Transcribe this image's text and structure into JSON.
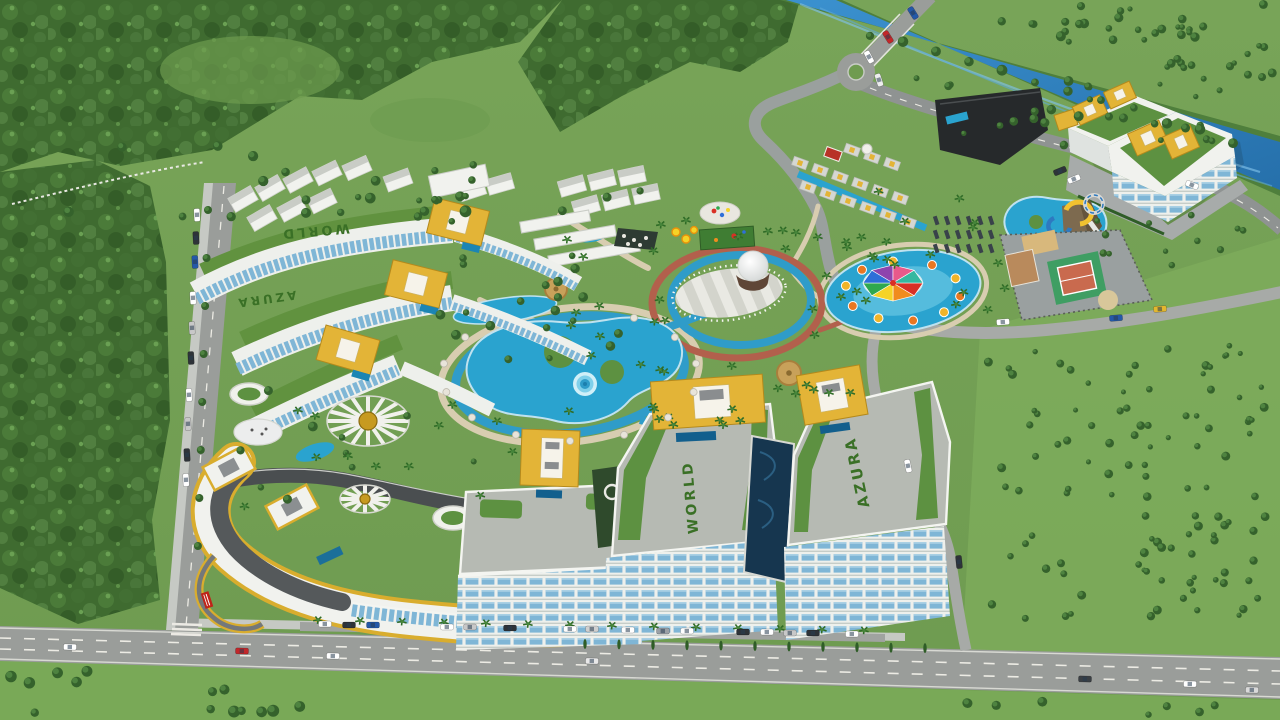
{
  "scene": {
    "type": "aerial-3d-architectural-render",
    "subject": "Azura World resort complex masterplan with water park, pools, amphitheater and river",
    "labels": {
      "tower_world_roof": "WORLD",
      "tower_azura_roof": "AZURA",
      "lawn_upper": "WORLD",
      "lawn_lower": "AZURA"
    },
    "palette": {
      "grass": "#76a155",
      "grass_light": "#7fae5c",
      "forest": "#3f6b30",
      "river": "#2f84c4",
      "road": "#9a9d9a",
      "sidewalk": "#c6c9c4",
      "building_white": "#f1f2ee",
      "roof_deck": "#b6bab3",
      "glass_blue": "#7fb6d6",
      "gold": "#e3b437",
      "pool_blue": "#2aa3cf",
      "canal_navy": "#16364f",
      "path_tan": "#d8cdb0",
      "track_red": "#b2604c",
      "lawn_green": "#5d9141",
      "hedge_green": "#3a7026",
      "court_green": "#3f9e63",
      "court_clay": "#c96a4e",
      "sand": "#d8b87c",
      "dark_roof": "#26292b",
      "accent_red": "#c0392b"
    },
    "splash_canopy_colors": [
      "#d93025",
      "#f08c1e",
      "#f5d327",
      "#2fa84f",
      "#2e6fd8",
      "#8e44ad",
      "#e8598a",
      "#35b8a0"
    ],
    "vehicles": [
      {
        "x": 70,
        "y": 647,
        "rot": 1,
        "color": "#ffffff"
      },
      {
        "x": 242,
        "y": 651,
        "rot": 1,
        "color": "#c2272a"
      },
      {
        "x": 333,
        "y": 656,
        "rot": 1,
        "color": "#ffffff"
      },
      {
        "x": 592,
        "y": 661,
        "rot": 1,
        "color": "#e8e8e8"
      },
      {
        "x": 1085,
        "y": 679,
        "rot": 1,
        "color": "#3a3f44"
      },
      {
        "x": 1190,
        "y": 684,
        "rot": 1,
        "color": "#ffffff"
      },
      {
        "x": 1252,
        "y": 690,
        "rot": 1,
        "color": "#d9d9d9"
      },
      {
        "x": 325,
        "y": 624,
        "rot": 0,
        "color": "#ffffff"
      },
      {
        "x": 349,
        "y": 625,
        "rot": 0,
        "color": "#2e3338"
      },
      {
        "x": 373,
        "y": 625,
        "rot": 0,
        "color": "#2458a8"
      },
      {
        "x": 447,
        "y": 627,
        "rot": 0,
        "color": "#ffffff"
      },
      {
        "x": 470,
        "y": 627,
        "rot": 0,
        "color": "#c8c8c8"
      },
      {
        "x": 510,
        "y": 628,
        "rot": 0,
        "color": "#2e3338"
      },
      {
        "x": 570,
        "y": 629,
        "rot": 0,
        "color": "#ffffff"
      },
      {
        "x": 592,
        "y": 629,
        "rot": 0,
        "color": "#d0d0d0"
      },
      {
        "x": 628,
        "y": 630,
        "rot": 0,
        "color": "#ffffff"
      },
      {
        "x": 663,
        "y": 631,
        "rot": 0,
        "color": "#9aa0a6"
      },
      {
        "x": 687,
        "y": 631,
        "rot": 0,
        "color": "#ffffff"
      },
      {
        "x": 743,
        "y": 632,
        "rot": 0,
        "color": "#2e3338"
      },
      {
        "x": 767,
        "y": 632,
        "rot": 0,
        "color": "#ffffff"
      },
      {
        "x": 790,
        "y": 633,
        "rot": 0,
        "color": "#c8c8c8"
      },
      {
        "x": 813,
        "y": 633,
        "rot": 0,
        "color": "#2e3338"
      },
      {
        "x": 852,
        "y": 634,
        "rot": 0,
        "color": "#ffffff"
      },
      {
        "x": 197,
        "y": 215,
        "rot": 87,
        "color": "#ffffff"
      },
      {
        "x": 196,
        "y": 238,
        "rot": 87,
        "color": "#2e3338"
      },
      {
        "x": 195,
        "y": 262,
        "rot": 87,
        "color": "#2458a8"
      },
      {
        "x": 193,
        "y": 298,
        "rot": 87,
        "color": "#ffffff"
      },
      {
        "x": 192,
        "y": 328,
        "rot": 87,
        "color": "#c8c8c8"
      },
      {
        "x": 191,
        "y": 358,
        "rot": 87,
        "color": "#2e3338"
      },
      {
        "x": 189,
        "y": 395,
        "rot": 87,
        "color": "#ffffff"
      },
      {
        "x": 188,
        "y": 424,
        "rot": 87,
        "color": "#c8c8c8"
      },
      {
        "x": 187,
        "y": 455,
        "rot": 87,
        "color": "#2e3338"
      },
      {
        "x": 186,
        "y": 480,
        "rot": 87,
        "color": "#ffffff"
      },
      {
        "x": 1003,
        "y": 322,
        "rot": -4,
        "color": "#ffffff"
      },
      {
        "x": 1116,
        "y": 318,
        "rot": -4,
        "color": "#2458a8"
      },
      {
        "x": 1160,
        "y": 309,
        "rot": -4,
        "color": "#e3b72e"
      },
      {
        "x": 908,
        "y": 466,
        "rot": 78,
        "color": "#ffffff"
      },
      {
        "x": 959,
        "y": 562,
        "rot": 84,
        "color": "#2e3338"
      },
      {
        "x": 913,
        "y": 13,
        "rot": 58,
        "color": "#2458a8"
      },
      {
        "x": 888,
        "y": 37,
        "rot": 58,
        "color": "#c2272a"
      },
      {
        "x": 869,
        "y": 57,
        "rot": 62,
        "color": "#ffffff"
      },
      {
        "x": 879,
        "y": 80,
        "rot": 72,
        "color": "#eeeeee"
      },
      {
        "x": 1192,
        "y": 185,
        "rot": 22,
        "color": "#ffffff"
      },
      {
        "x": 1060,
        "y": 171,
        "rot": -22,
        "color": "#2e3338"
      },
      {
        "x": 1074,
        "y": 179,
        "rot": -22,
        "color": "#ffffff"
      }
    ]
  }
}
